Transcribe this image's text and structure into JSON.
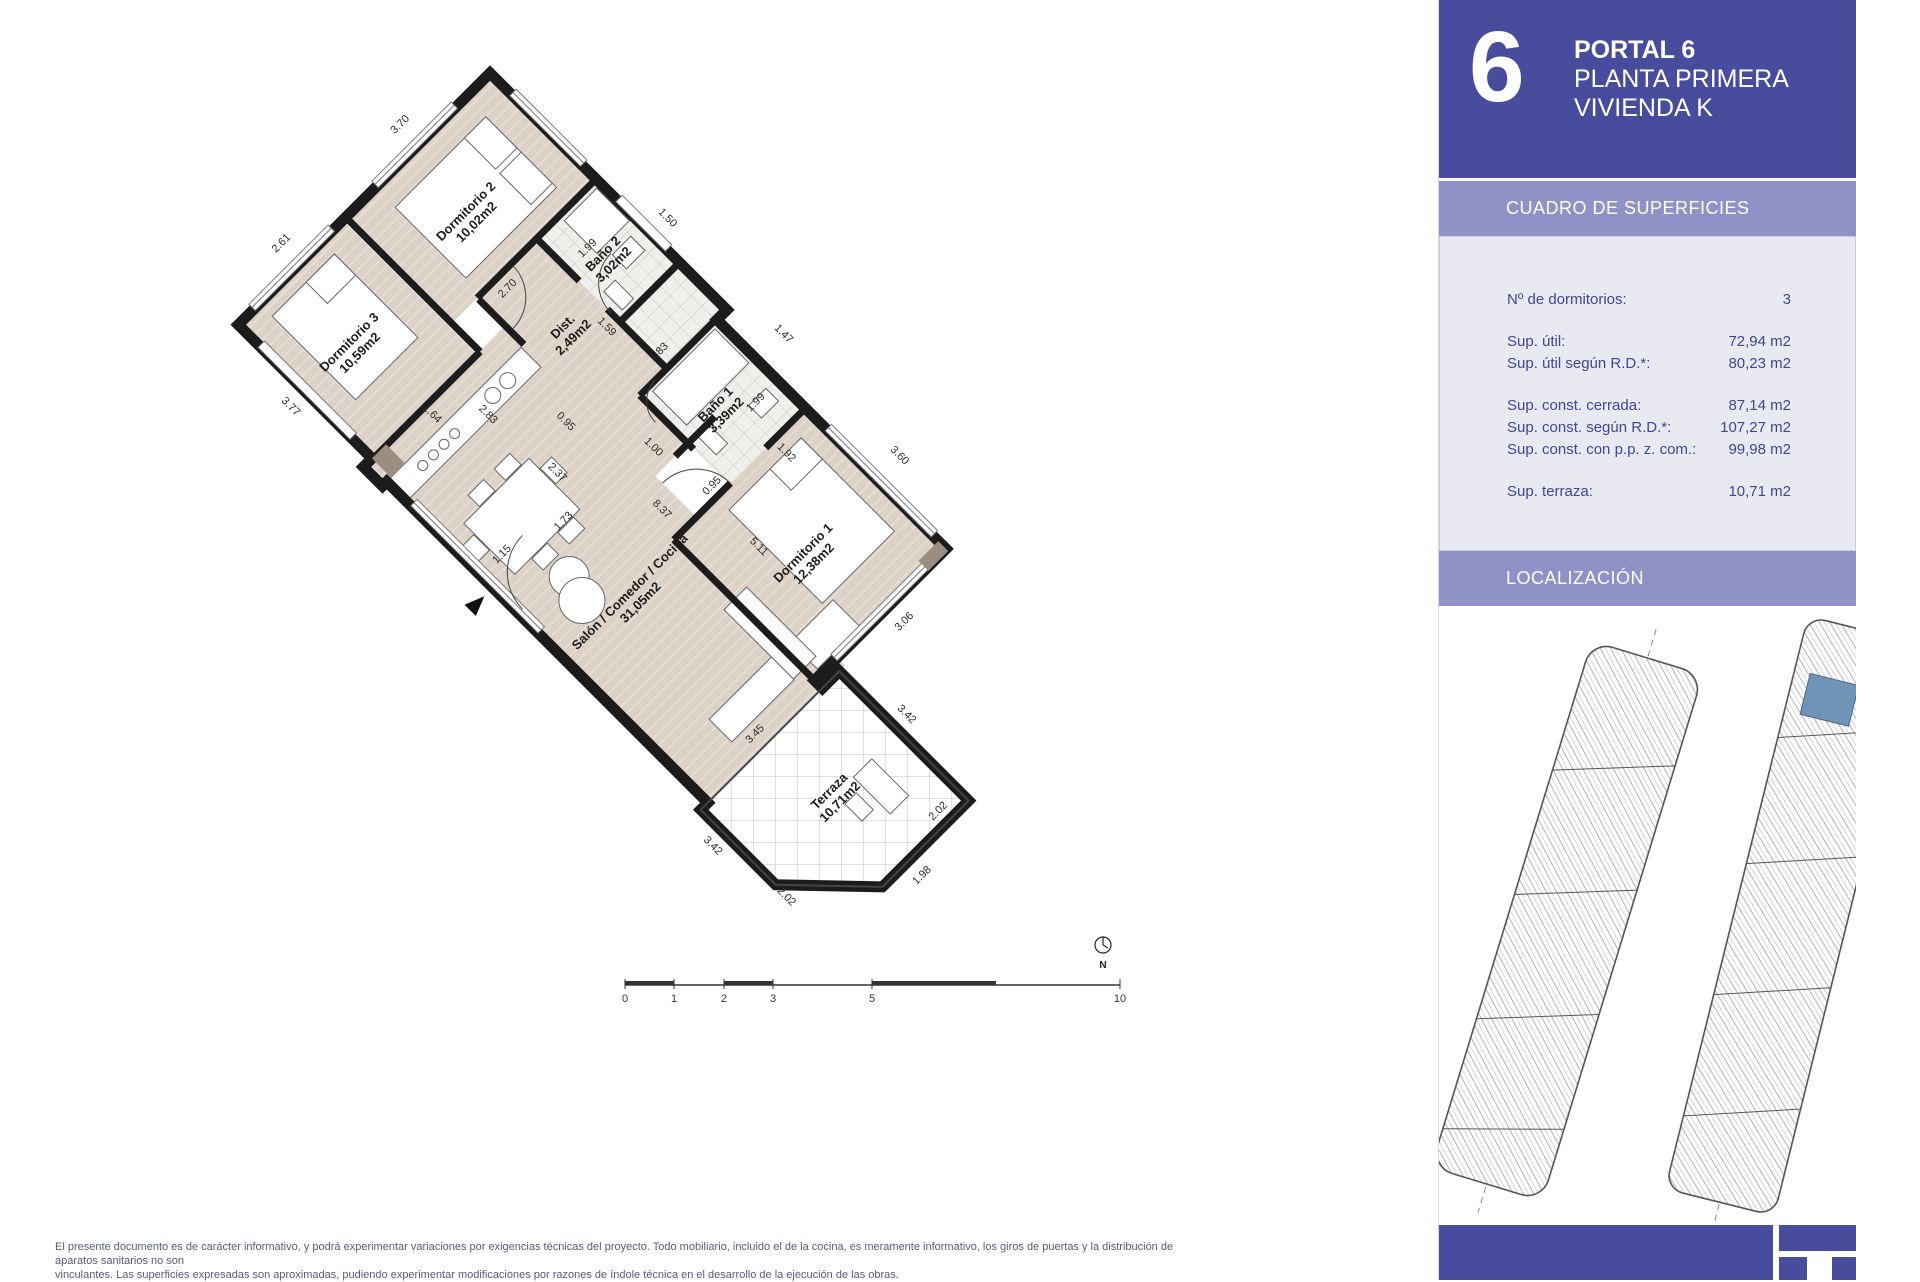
{
  "colors": {
    "header_bg": "#484c9c",
    "section_bar_bg": "#8e92c6",
    "panel_bg": "#e9eaf1",
    "panel_text": "#3d4795",
    "floor_beige": "#dcd2c8",
    "wall_black": "#1c1c1c",
    "unit_highlight_blue": "#6f94b5"
  },
  "header": {
    "unit_number": "6",
    "title_line1": "PORTAL 6",
    "title_line2": "PLANTA PRIMERA",
    "title_line3": "VIVIENDA K"
  },
  "surfaces": {
    "title": "CUADRO DE SUPERFICIES",
    "rows": [
      {
        "label": "Nº de dormitorios:",
        "value": "3",
        "group": 1
      },
      {
        "label": "Sup. útil:",
        "value": "72,94 m2",
        "group": 2
      },
      {
        "label": "Sup. útil según R.D.*:",
        "value": "80,23 m2",
        "group": 2
      },
      {
        "label": "Sup. const. cerrada:",
        "value": "87,14 m2",
        "group": 3
      },
      {
        "label": "Sup. const. según R.D.*:",
        "value": "107,27 m2",
        "group": 3
      },
      {
        "label": "Sup. const. con p.p. z. com.:",
        "value": "99,98 m2",
        "group": 3
      },
      {
        "label": "Sup. terraza:",
        "value": "10,71 m2",
        "group": 4
      }
    ]
  },
  "localizacion": {
    "title": "LOCALIZACIÓN"
  },
  "plan": {
    "north_label": "N",
    "rooms": [
      {
        "id": "dormitorio-2",
        "name": "Dormitorio 2",
        "area": "10,02m2",
        "x": 85,
        "y": 115
      },
      {
        "id": "dormitorio-3",
        "name": "Dormitorio 3",
        "area": "10,59m2",
        "x": 95,
        "y": 290
      },
      {
        "id": "bano-2",
        "name": "Baño 2",
        "area": "3,02m2",
        "x": 212,
        "y": 48
      },
      {
        "id": "bano-1",
        "name": "Baño 1",
        "area": "3,39m2",
        "x": 398,
        "y": 75
      },
      {
        "id": "dist",
        "name": "Dist.",
        "area": "2,49m2",
        "x": 235,
        "y": 128
      },
      {
        "id": "dormitorio-1",
        "name": "Dormitorio 1",
        "area": "12,38m2",
        "x": 565,
        "y": 118
      },
      {
        "id": "salon",
        "name": "Salón / Comedor / Cocina",
        "area": "31,05m2",
        "x": 470,
        "y": 268
      },
      {
        "id": "terraza",
        "name": "Terraza",
        "area": "10,71m2",
        "x": 752,
        "y": 268
      }
    ],
    "dimensions": [
      {
        "t": "3.70",
        "x": -24,
        "y": 100,
        "r": -90
      },
      {
        "t": "2.61",
        "x": -24,
        "y": 268,
        "r": -90
      },
      {
        "t": "2.70",
        "x": 168,
        "y": 140,
        "r": -90
      },
      {
        "t": "1.59",
        "x": 262,
        "y": 100,
        "r": 0
      },
      {
        "t": "0.95",
        "x": 300,
        "y": 196,
        "r": 0
      },
      {
        "t": "1.00",
        "x": 380,
        "y": 152,
        "r": 0
      },
      {
        "t": "1.83",
        "x": 320,
        "y": 78,
        "r": -90
      },
      {
        "t": "1.99",
        "x": 196,
        "y": 55,
        "r": -90
      },
      {
        "t": "1.50",
        "x": 228,
        "y": -20,
        "r": 0
      },
      {
        "t": "1.47",
        "x": 392,
        "y": -20,
        "r": 0
      },
      {
        "t": "1.99",
        "x": 424,
        "y": 45,
        "r": -90
      },
      {
        "t": "1.92",
        "x": 478,
        "y": 62,
        "r": 0
      },
      {
        "t": "3.60",
        "x": 560,
        "y": -16,
        "r": 0
      },
      {
        "t": "3.06",
        "x": 684,
        "y": 95,
        "r": -90
      },
      {
        "t": "0.95",
        "x": 452,
        "y": 135,
        "r": -90
      },
      {
        "t": "5.11",
        "x": 525,
        "y": 148,
        "r": 0
      },
      {
        "t": "8.37",
        "x": 430,
        "y": 190,
        "r": 0
      },
      {
        "t": "2.37",
        "x": 330,
        "y": 238,
        "r": 0
      },
      {
        "t": "1.73",
        "x": 372,
        "y": 265,
        "r": -90
      },
      {
        "t": "1.15",
        "x": 352,
        "y": 332,
        "r": -90
      },
      {
        "t": "1.64",
        "x": 200,
        "y": 285,
        "r": 0
      },
      {
        "t": "2.83",
        "x": 240,
        "y": 246,
        "r": 0
      },
      {
        "t": "3.77",
        "x": 95,
        "y": 380,
        "r": 0
      },
      {
        "t": "3.45",
        "x": 658,
        "y": 280,
        "r": -90
      },
      {
        "t": "3.42",
        "x": 748,
        "y": 162,
        "r": 0
      },
      {
        "t": "2.02",
        "x": 842,
        "y": 205,
        "r": -90
      },
      {
        "t": "1.98",
        "x": 876,
        "y": 262,
        "r": -90
      },
      {
        "t": "2.02",
        "x": 792,
        "y": 376,
        "r": 0
      },
      {
        "t": "3.42",
        "x": 704,
        "y": 392,
        "r": 0
      }
    ]
  },
  "scalebar": {
    "labels": [
      {
        "t": "0",
        "x": 625
      },
      {
        "t": "1",
        "x": 674
      },
      {
        "t": "2",
        "x": 724
      },
      {
        "t": "3",
        "x": 773
      },
      {
        "t": "5",
        "x": 872
      },
      {
        "t": "10",
        "x": 1120
      }
    ]
  },
  "disclaimer": {
    "line1": "El presente documento es de carácter informativo, y podrá experimentar variaciones por exigencias técnicas del proyecto. Todo mobiliario, incluido el de la cocina, es meramente informativo, los giros de puertas y la distribución de aparatos sanitarios no son",
    "line2": "vinculantes. Las superficies expresadas son aproximadas, pudiendo experimentar modificaciones por razones de índole técnica en el desarrollo de la ejecución de las obras."
  }
}
